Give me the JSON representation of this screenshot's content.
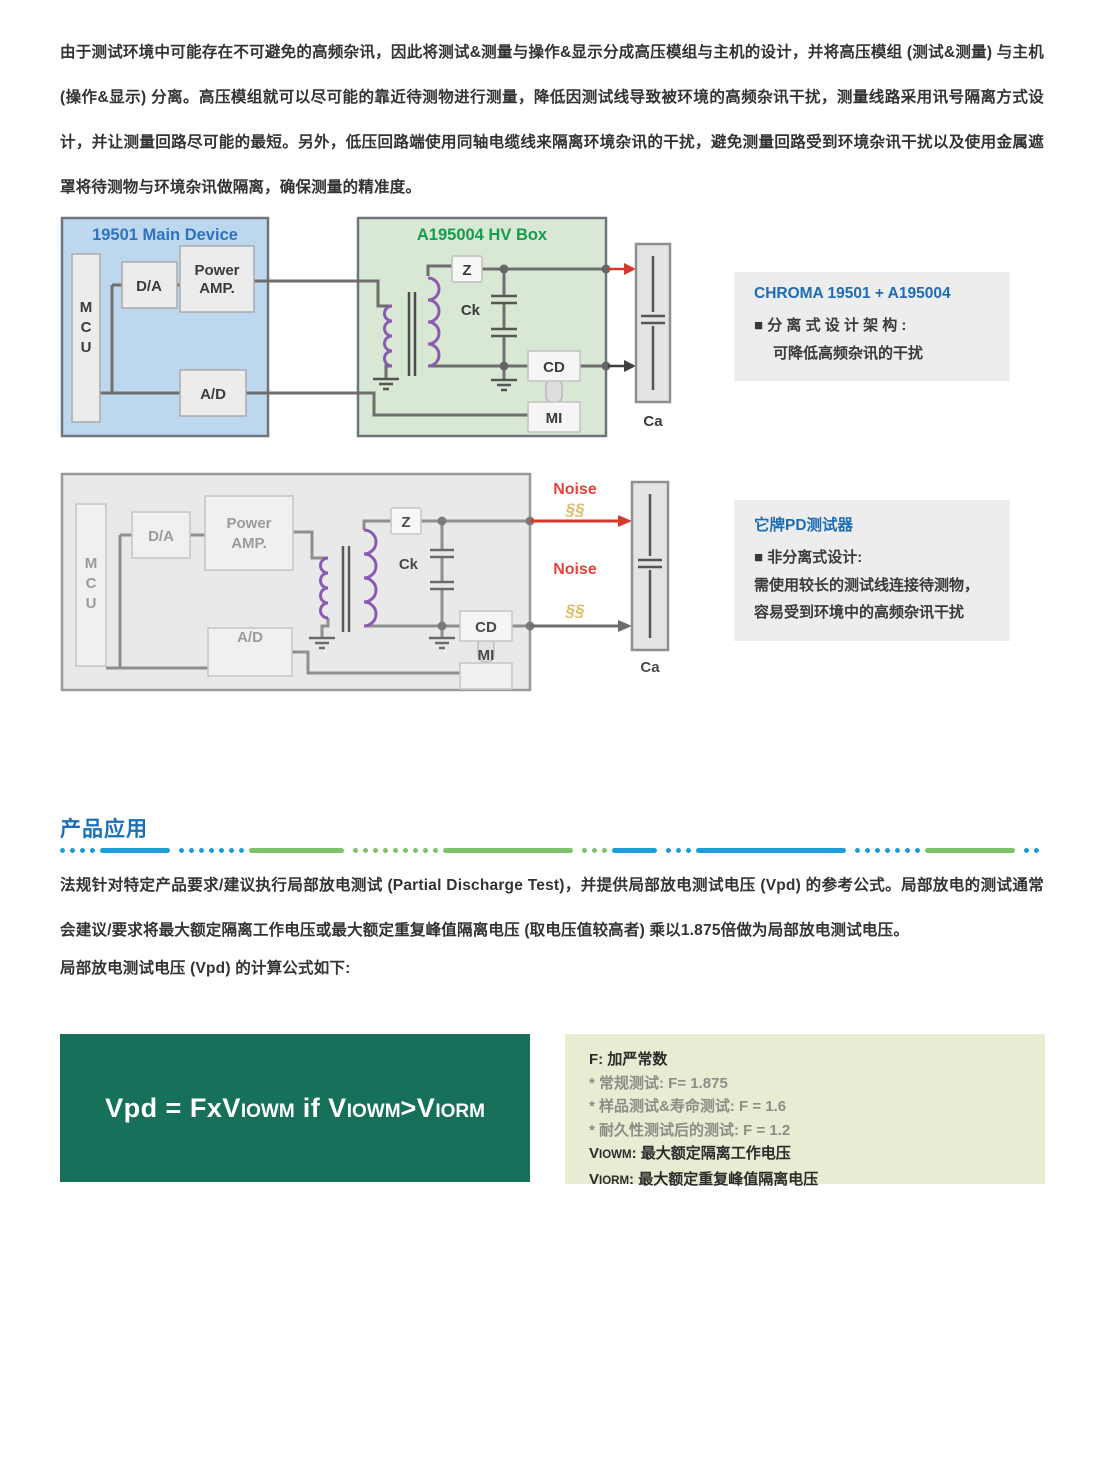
{
  "intro_paragraph": "由于测试环境中可能存在不可避免的高频杂讯，因此将测试&测量与操作&显示分成高压模组与主机的设计，并将高压模组 (测试&测量) 与主机 (操作&显示) 分离。高压模组就可以尽可能的靠近待测物进行测量，降低因测试线导致被环境的高频杂讯干扰，测量线路采用讯号隔离方式设计，并让测量回路尽可能的最短。另外，低压回路端使用同轴电缆线来隔离环境杂讯的干扰，避免测量回路受到环境杂讯干扰以及使用金属遮罩将待测物与环境杂讯做隔离，确保测量的精准度。",
  "circuit_labels": {
    "mcu": [
      "M",
      "C",
      "U"
    ],
    "da": "D/A",
    "power1": "Power",
    "power2": "AMP.",
    "ad": "A/D",
    "z": "Z",
    "ck": "Ck",
    "cd": "CD",
    "mi": "MI",
    "ca": "Ca"
  },
  "diagram1": {
    "main_device_title": "19501 Main Device",
    "hv_box_title": "A195004 HV Box"
  },
  "diagram2": {
    "noise": "Noise",
    "zap": "§§"
  },
  "callout1": {
    "title": "CHROMA 19501 + A195004",
    "bullet_line": "■ 分 离 式 设 计 架 构 :",
    "line2": "可降低高频杂讯的干扰"
  },
  "callout2": {
    "title": "它牌PD测试器",
    "bullet_line": "■ 非分离式设计:",
    "line2": "需使用较长的测试线连接待测物，",
    "line3": "容易受到环境中的高频杂讯干扰"
  },
  "section_title": "产品应用",
  "application_paragraph": "法规针对特定产品要求/建议执行局部放电测试 (Partial Discharge Test)，并提供局部放电测试电压 (Vpd) 的参考公式。局部放电的测试通常会建议/要求将最大额定隔离工作电压或最大额定重复峰值隔离电压 (取电压值较高者) 乘以1.875倍做为局部放电测试电压。",
  "formula_intro": "局部放电测试电压 (Vpd) 的计算公式如下:",
  "formula": {
    "p1": "Vpd = FxV",
    "s1": "IOWM",
    "p2": " if V",
    "s2": "IOWM",
    "p3": ">V",
    "s3": "IORM"
  },
  "legend": {
    "f_line": "F: 加严常数",
    "star1": "* 常规测试: F= 1.875",
    "star2": "* 样品测试&寿命测试: F = 1.6",
    "star3": "* 耐久性测试后的测试: F = 1.2",
    "viowm_prefix": "V",
    "viowm_sub": "IOWM",
    "viowm_desc": ": 最大额定隔离工作电压",
    "viorm_prefix": "V",
    "viorm_sub": "IORM",
    "viorm_desc": ": 最大额定重复峰值隔离电压"
  },
  "colors": {
    "header_blue": "#1B6FB8",
    "title_blue": "#2E73BF",
    "title_green": "#169C4D",
    "formula_green": "#17705A",
    "legend_bg": "#E9ECD3",
    "callout_bg": "#EDEDED",
    "noise_red": "#E8403A",
    "coil_purple": "#8A5BB0",
    "divider_blue": "#1E9CD7",
    "divider_green": "#7CC269"
  }
}
